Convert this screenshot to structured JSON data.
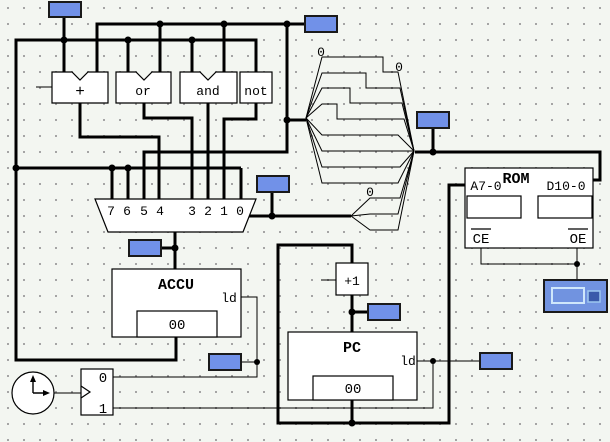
{
  "app": {
    "title": "CPU logic circuit schematic"
  },
  "colors": {
    "background": "#f3f6f1",
    "grid_dot": "#a5a5a5",
    "wire": "#000000",
    "component_fill": "#ffffff",
    "probe_fill": "#7191e8",
    "probe_border": "#1a1a1a",
    "display_fill": "#7193e0",
    "display_inner_square": "#3a5aaa",
    "display_highlight": "#cfe7fb"
  },
  "alu": {
    "adder_label": "+",
    "or_label": "or",
    "and_label": "and",
    "not_label": "not"
  },
  "mux": {
    "input_labels": [
      "7",
      "6",
      "5",
      "4",
      "3",
      "2",
      "1",
      "0"
    ]
  },
  "splitters": {
    "fan1_bit_label": "0",
    "fan2_bit_label": "0",
    "fan3_bit_label": "0"
  },
  "rom": {
    "title": "ROM",
    "address_port": "A7-0",
    "data_port": "D10-0",
    "chip_enable": "CE",
    "output_enable": "OE",
    "address_value": "",
    "data_value": ""
  },
  "accu": {
    "title": "ACCU",
    "load_label": "ld",
    "value": "00"
  },
  "pc": {
    "title": "PC",
    "load_label": "ld",
    "value": "00"
  },
  "incrementer": {
    "label": "+1"
  },
  "phase_generator": {
    "phase0_label": "0",
    "phase1_label": "1"
  }
}
